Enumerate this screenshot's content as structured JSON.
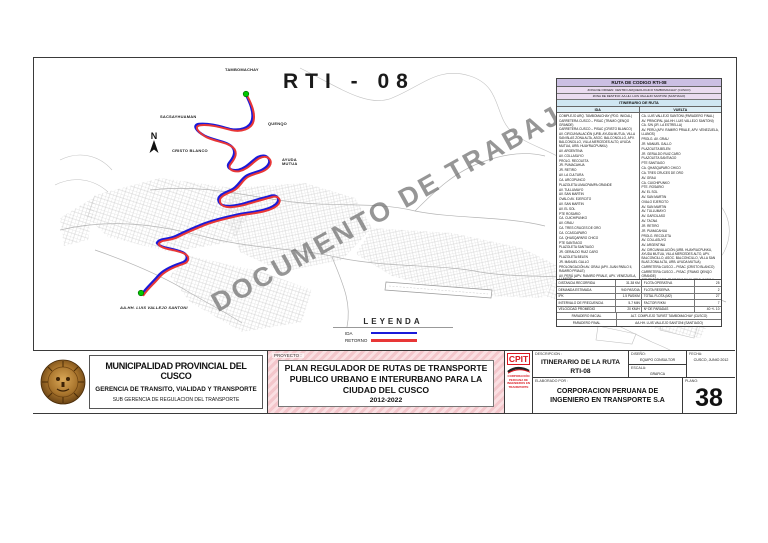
{
  "map": {
    "route_code": "RTI - 08",
    "watermark": "DOCUMENTO DE TRABAJO",
    "compass_label": "N",
    "labels": {
      "tambomachay": "TAMBOMACHAY",
      "sacsayhuaman": "SACSAYHUAMAN",
      "quenqo": "QUENQO",
      "cristo_blanco": "CRISTO BLANCO",
      "ayuda_mutua": "AYUDA MUTUA",
      "vallejo_santoni": "AA.HH. LUIS VALLEJO SANTONI"
    },
    "legend": {
      "title": "LEYENDA",
      "ida_label": "IDA",
      "retorno_label": "RETORNO",
      "ida_color": "#1a1ad9",
      "retorno_color": "#e83636"
    },
    "endpoint_color": "#00c800"
  },
  "route_table": {
    "title": "RUTA DE CODIGO RTI-08",
    "origin": "ZONA DE ORIGEN: CENTRO ARQUEOLOGICO TAMBOMACHAY (CUSCO)",
    "destination": "ZONA DE DESTINO: AA.HH. LUIS VALLEJO SANTONI (SANTIAGO)",
    "itinerary_header": "ITINERARIO DE RUTA",
    "col_ida": "IDA",
    "col_vuelta": "VUELTA",
    "ida": [
      "COMPLEJO ARQ. TAMBOMACHAY (PDO. INICIAL)",
      "CARRETERA CUSCO – PISAC (TRAMO QENQO GRANDE)",
      "CARRETERA CUSCO – PISAC (CRISTO BLANCO)",
      "AV. CIRCUNVALACIÓN (URB. AYUDA MUTUA, VILLA SAN BLAS ZONA ALTA, ASOC. BALCONCILLO, APV. BALCONCILLO, VILLA MERCEDES ALTO, AYUDA MUTUA, URB. HUAYRACPUNKU)",
      "AV. ARGENTINA",
      "AV. COLLASUYO",
      "PROLG. RECOLETA",
      "JR. PUMACAHUA",
      "JR. RETIRO",
      "AV. LA CULTURA",
      "CA. ARCOPUNCO",
      "PLAZOLETA LIMACPAMPA GRANDE",
      "AV. TULLUMAYO",
      "AV. SAN MARTIN",
      "OVALO AV. EJERCITO",
      "AV. SAN MARTIN",
      "AV. EL SOL",
      "PTE ROSARIO",
      "CA. CUICHIPUNKO",
      "AV. GRAU",
      "CA. TRES CRUCES DE ORO",
      "CA. CCASCAPARO",
      "CA. QHASQAPARO CHICO",
      "PTE SANTIAGO",
      "PLAZOLETA SANTIAGO",
      "JR. GERALDO RUIZ CARO",
      "PLAZOLETA BELEN",
      "JR. MANUEL GALLO",
      "PROLONGACIÓN AV. GRAU (APV. JUAN PABLO II, RAMIRO PRIALE)",
      "AV. PERÚ (APV. RAMIRO PRIALE, APV. VENEZUELA, LLANOS)",
      "CA. S/N (JR. LA ESTRELLA)",
      "AV. PRINCIPAL (AA.HH. LUIS VALLEJO SANTONI)",
      "CA. LUIS VALLEJO SANTONI"
    ],
    "vuelta": [
      "CA. LUIS VALLEJO SANTONI (PARADERO FINAL)",
      "AV. PRINCIPAL (AA.HH. LUIS VALLEJO SANTONI)",
      "CA. S/N (JR. LA ESTRELLA)",
      "AV. PERÚ (APV. RAMIRO PRIALE, APV. VENEZUELA, LLANOS)",
      "PROLG. AV. GRAU",
      "JR. MANUEL GALLO",
      "PLAZOLETA BELEN",
      "JR. GERALDO RUIZ CARO",
      "PLAZOLETA SANTIAGO",
      "PTE SANTIAGO",
      "CA. QHASQAPARO CHICO",
      "CA. TRES CRUCES DE ORO",
      "AV. GRAU",
      "CA. CUICHIPUNKO",
      "PTE. ROSARIO",
      "AV. EL SOL",
      "AV. SAN MARTIN",
      "OVALO EJERCITO",
      "AV. SAN MARTIN",
      "AV. TULLUMAYO",
      "AV. GARCILASO",
      "AV. TACNA",
      "JR. RETIRO",
      "JR. PUMACAHUA",
      "PROLG. RECOLETA",
      "AV. COLLASUYO",
      "AV. ARGENTINA",
      "AV. CIRCUNVALACIÓN (URB. HUAYRACPUNKU, AYUDA MUTUA, VILLA MERCEDES ALTO, APV. BALCONCILLO, ASOC. BALCONCILLO, VILLA SAN BLAS ZONA ALTA, URB. AYUDA MUTUA)",
      "CARRETERA CUSCO – PISAC (CRISTO BLANCO)",
      "CARRETERA CUSCO – PISAC (TRAMO QENQO GRANDE)",
      "COMPLEJO ARQ. TAMBOMACHAY (PDO. INICIAL)"
    ],
    "stats": [
      [
        "DISTANCIA RECORRIDA",
        "31.38 KM",
        "FLOTA OPERATIVA",
        "25"
      ],
      [
        "DEMANDA ESTIMADA",
        "940 PAS/DIA",
        "FLOTA RESERVA",
        "2"
      ],
      [
        "IPK",
        "1.5 PAS/KM",
        "TOTAL FLOTA (M2)",
        "27"
      ],
      [
        "INTERVALO DE FRECUENCIA",
        "5-7 MIN",
        "FACTOR R/KM",
        "7"
      ],
      [
        "VELOCIDAD PROMEDIO",
        "20 KM/H",
        "Nº DE PARADAS",
        "40 +/- 10"
      ]
    ],
    "paradero_inicial_label": "PARADERO INICIAL",
    "paradero_inicial": "ALT. COMPLEJO TURIST TAMBOMACHAY (CUSCO)",
    "paradero_final_label": "PARADERO FINAL",
    "paradero_final": "AA.HH. LUIS VALLEJO SANTONI (SANTIAGO)"
  },
  "titleblock": {
    "municipality": {
      "name": "MUNICIPALIDAD PROVINCIAL DEL CUSCO",
      "gerencia": "GERENCIA DE TRANSITO, VIALIDAD Y TRANSPORTE",
      "subgerencia": "SUB GERENCIA DE REGULACION DEL TRANSPORTE"
    },
    "project": {
      "label": "PROYECTO :",
      "line1": "PLAN REGULADOR DE RUTAS DE TRANSPORTE",
      "line2": "PUBLICO URBANO E INTERURBANO PARA LA",
      "line3": "CIUDAD DEL CUSCO",
      "years": "2012-2022"
    },
    "cpit": {
      "acronym": "CPIT",
      "org": "CORPORACIÓN PERUANA DE INGENIEROS EN TRANSPORTE",
      "accent_color": "#d91820"
    },
    "description": {
      "label": "DESCRIPCION :",
      "line1": "ITINERARIO DE LA RUTA",
      "line2": "RTI-08"
    },
    "diseno": {
      "label": "DISEÑO:",
      "value": "EQUIPO CONSULTOR"
    },
    "escala": {
      "label": "ESCALA:",
      "value": "GRAFICA"
    },
    "fecha": {
      "label": "FECHA:",
      "value": "CUSCO, JUNIO 2012"
    },
    "plano": {
      "label": "PLANO:",
      "number": "38"
    },
    "elaborado": {
      "label": "ELABORADO POR :",
      "line1": "CORPORACION PERUANA DE",
      "line2": "INGENIERO EN TRANSPORTE S.A"
    }
  }
}
